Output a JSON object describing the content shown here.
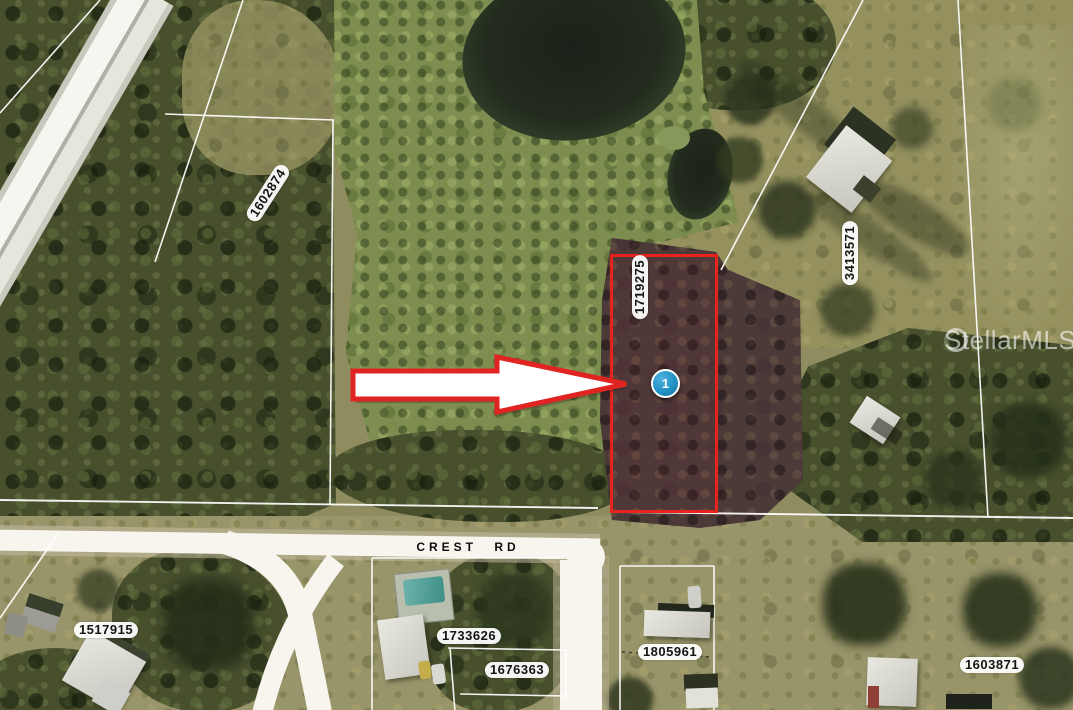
{
  "map": {
    "watermark": {
      "text": "StellarMLS"
    },
    "road": {
      "name": "CREST RD"
    },
    "marker": {
      "label": "1",
      "color": "#2191c4"
    },
    "colors": {
      "highlight_outline": "#e8231d",
      "arrow_fill": "#ffffff",
      "arrow_outline": "#e02421",
      "parcel_label_bg": "#ffffff",
      "parcel_label_text": "#141414"
    },
    "parcels": [
      {
        "id": "1602874",
        "highlighted": false
      },
      {
        "id": "1719275",
        "highlighted": true
      },
      {
        "id": "3413571",
        "highlighted": false
      },
      {
        "id": "1517915",
        "highlighted": false
      },
      {
        "id": "1733626",
        "highlighted": false
      },
      {
        "id": "1676363",
        "highlighted": false
      },
      {
        "id": "1805961",
        "highlighted": false
      },
      {
        "id": "1603871",
        "highlighted": false
      }
    ]
  }
}
